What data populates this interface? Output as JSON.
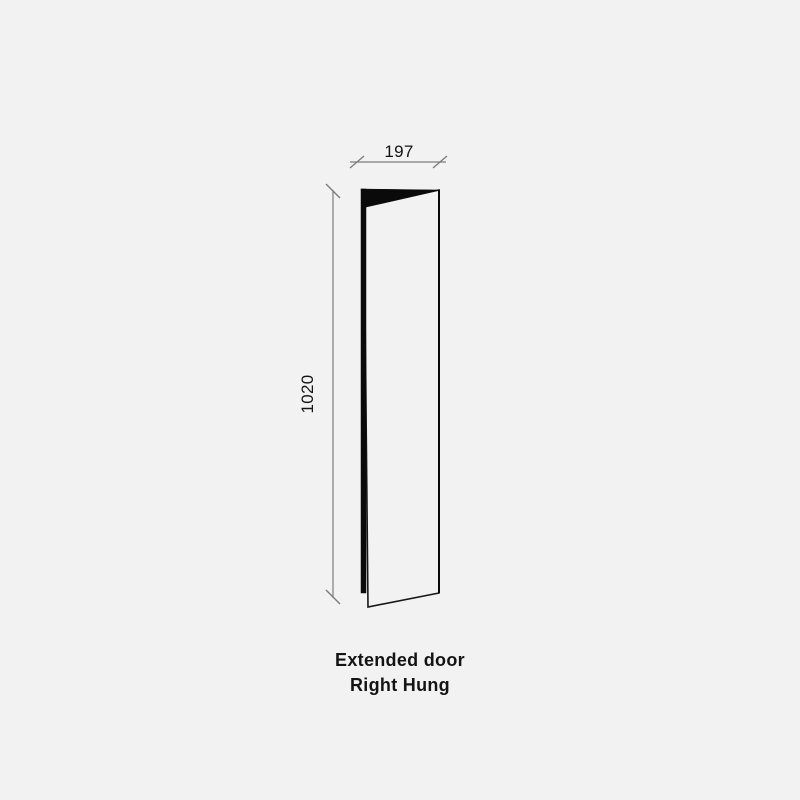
{
  "page": {
    "background_color": "#f2f2f2"
  },
  "diagram": {
    "type": "door-technical-drawing",
    "caption": {
      "line1": "Extended door",
      "line2": "Right Hung"
    },
    "dimensions": {
      "width_mm": "197",
      "height_mm": "1020"
    },
    "colors": {
      "outline": "#161616",
      "solid_fill": "#0a0a0a",
      "dimension_line": "#7d7d7d",
      "text": "#141414",
      "background": "#f2f2f2"
    }
  }
}
